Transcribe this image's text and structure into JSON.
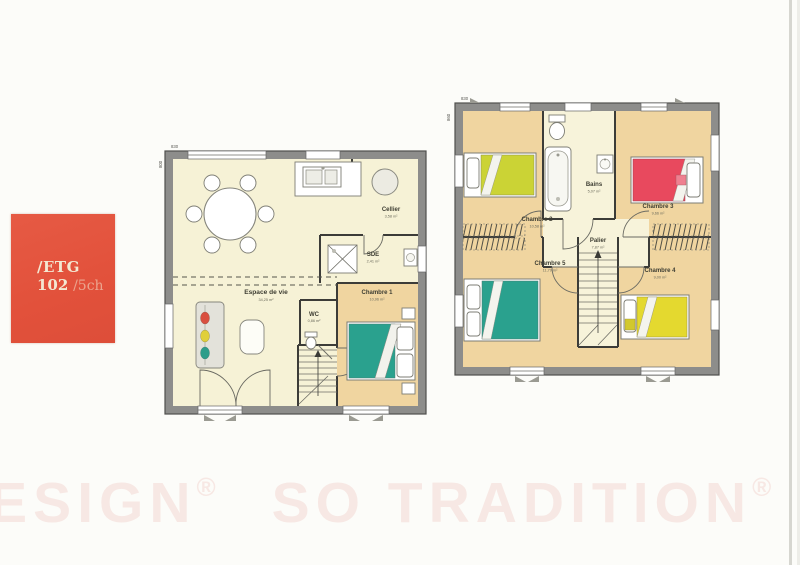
{
  "document": {
    "badge": {
      "line1": "/ETG",
      "number": "102",
      "suffix": "/5ch"
    },
    "watermark": {
      "word1": "DESIGN",
      "reg1": "®",
      "word2": "SO TRADITION",
      "reg2": "®",
      "word3": "SO"
    },
    "ground_floor": {
      "dim_width": "830",
      "dim_height": "800",
      "rooms": [
        {
          "name": "Espace de vie",
          "area": "34,25 m²"
        },
        {
          "name": "Cellier",
          "area": "3,58 m²"
        },
        {
          "name": "SDE",
          "area": "2,41 m²"
        },
        {
          "name": "WC",
          "area": "0,86 m²"
        },
        {
          "name": "Chambre 1",
          "area": "10,96 m²"
        }
      ]
    },
    "upper_floor": {
      "dim_width": "830",
      "dim_height": "860",
      "rooms": [
        {
          "name": "Chambre 2",
          "area": "10,58 m²"
        },
        {
          "name": "Bains",
          "area": "5,07 m²"
        },
        {
          "name": "Chambre 3",
          "area": "9,66 m²"
        },
        {
          "name": "Palier",
          "area": "7,87 m²"
        },
        {
          "name": "Chambre 5",
          "area": "11,79 m²"
        },
        {
          "name": "Chambre 4",
          "area": "9,00 m²"
        }
      ]
    },
    "colors": {
      "badge_red": "#e2543e",
      "wall_gray": "#8d8d8b",
      "floor_cream": "#f6f2d6",
      "floor_wood": "#f0d5a0",
      "bains_cream": "#f7f3da",
      "bed_teal": "#2aa18e",
      "bed_green": "#cbd335",
      "bed_red": "#e8495e",
      "bed_yellow": "#e4d92f",
      "watermark_pink": "#f7e8e4"
    }
  }
}
